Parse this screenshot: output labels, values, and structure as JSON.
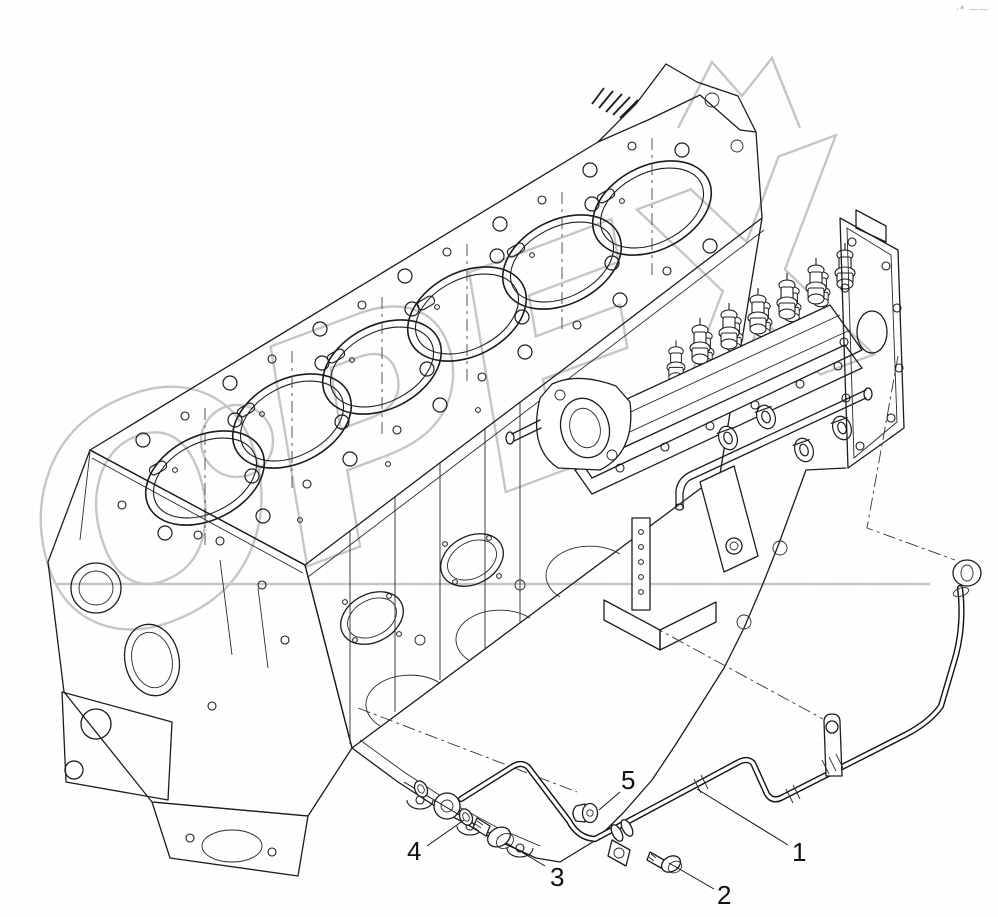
{
  "figure": {
    "callouts": [
      {
        "label": "1"
      },
      {
        "label": "2"
      },
      {
        "label": "3"
      },
      {
        "label": "4"
      },
      {
        "label": "5"
      }
    ],
    "watermark": {
      "text": "ОРЕХ",
      "color": "#b3b3b3"
    },
    "corner_mark": "·* ——",
    "colors": {
      "background": "#ffffff",
      "line": "#1c1c1c",
      "watermark_gray": "#b3b3b3"
    }
  }
}
